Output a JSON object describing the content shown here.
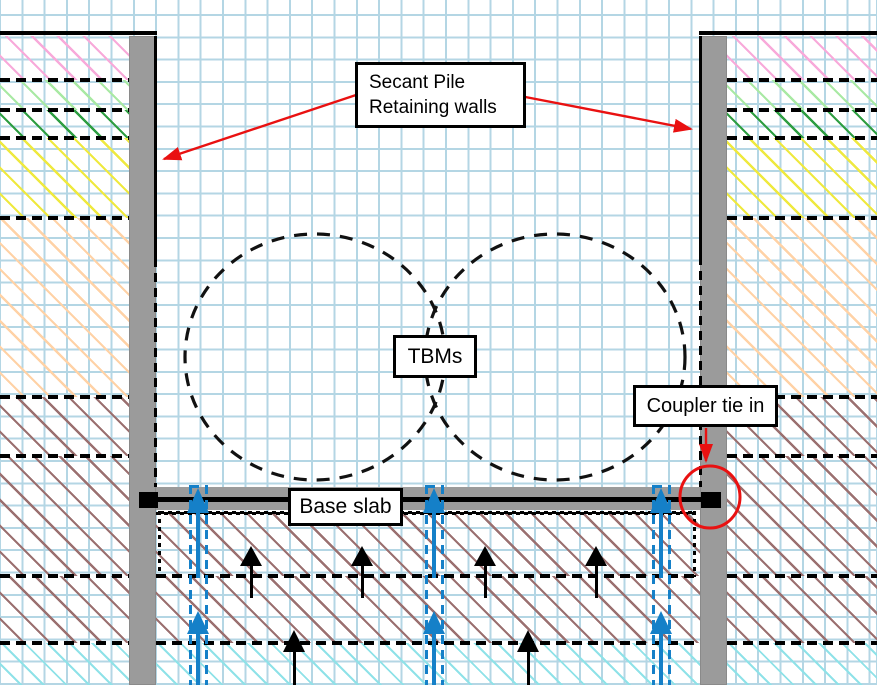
{
  "labels": {
    "secant_line1": "Secant Pile",
    "secant_line2": "Retaining walls",
    "tbms": "TBMs",
    "base_slab": "Base slab",
    "coupler": "Coupler tie in"
  },
  "colors": {
    "grid_line": "#b4d6e4",
    "wall_gray": "#9b9b9b",
    "slab_gray": "#9b9b9b",
    "line_black": "#000000",
    "pile_blue": "#1580c8",
    "annotation_red": "#e91111",
    "label_bg": "#ffffff",
    "label_border": "#000000",
    "hatch_pink": "#f8aada",
    "hatch_light_green": "#a9e9a4",
    "hatch_dark_green": "#2f9e42",
    "hatch_yellow": "#efe93f",
    "hatch_peach": "#ffd2a6",
    "hatch_brown": "#9b7070",
    "hatch_cyan": "#8fe2e8"
  },
  "soil_layers": [
    {
      "y": 36,
      "h": 44,
      "color": "#f8aada",
      "line": ""
    },
    {
      "y": 80,
      "h": 30,
      "color": "#a9e9a4",
      "line": "dashed"
    },
    {
      "y": 110,
      "h": 28,
      "color": "#2f9e42",
      "line": "dashed"
    },
    {
      "y": 138,
      "h": 80,
      "color": "#efe93f",
      "line": "dashed"
    },
    {
      "y": 218,
      "h": 179,
      "color": "#ffd2a6",
      "line": "dashed"
    },
    {
      "y": 397,
      "h": 59,
      "color": "#9b7070",
      "line": "dashed"
    },
    {
      "y": 456,
      "h": 120,
      "color": "#9b7070",
      "line": "dashed"
    },
    {
      "y": 576,
      "h": 67,
      "color": "#9b7070",
      "line": "dashed"
    },
    {
      "y": 643,
      "h": 42,
      "color": "#8fe2e8",
      "line": "dashed",
      "gap": 14,
      "lw": 2
    }
  ],
  "inner_layers": [
    {
      "y": 513,
      "h": 63,
      "color": "#9b7070",
      "line": "dotted"
    },
    {
      "y": 576,
      "h": 67,
      "color": "#9b7070",
      "line": "dashed"
    },
    {
      "y": 643,
      "h": 42,
      "color": "#8fe2e8",
      "line": "dashed",
      "gap": 14,
      "lw": 2
    }
  ],
  "piles": {
    "x_centers": [
      198,
      434,
      661
    ],
    "width": 16,
    "top": 485
  },
  "pile_arrows": {
    "upper": {
      "tip": 488,
      "head": 25,
      "shaft_to": 578
    },
    "lower": {
      "tip": 611,
      "head": 23,
      "shaft_to": 685
    }
  },
  "uplift_arrows": {
    "row1": {
      "x": [
        251,
        362,
        485,
        596
      ],
      "tip": 546,
      "head": 20,
      "shaft_to": 598
    },
    "row2": {
      "x": [
        294,
        528
      ],
      "tip": 630,
      "head": 22,
      "shaft_to": 685
    }
  },
  "wall_edge_lines": {
    "left": {
      "x": 154,
      "solid_from": 36,
      "solid_to": 258,
      "dash_to": 487
    },
    "right": {
      "x": 699,
      "solid_from": 36,
      "solid_to": 256,
      "dash_to": 487
    }
  }
}
